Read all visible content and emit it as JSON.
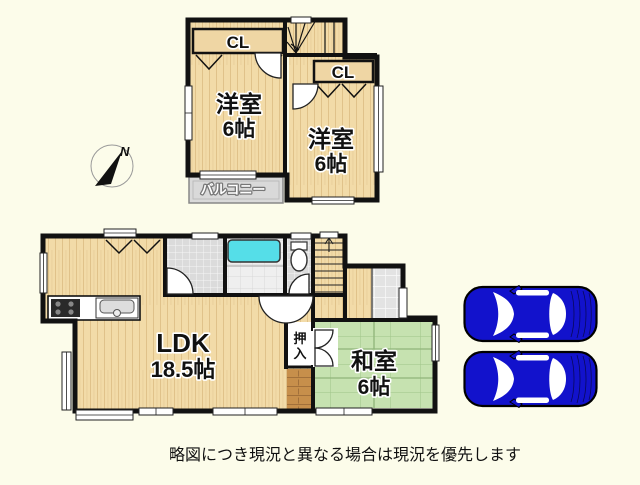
{
  "disclaimer": "略図につき現況と異なる場合は現況を優先します",
  "compass": {
    "label": "N"
  },
  "floor2": {
    "room_left": {
      "name": "洋室",
      "size": "6帖"
    },
    "room_right": {
      "name": "洋室",
      "size": "6帖"
    },
    "closet_left_label": "CL",
    "closet_right_label": "CL",
    "balcony_label": "バルコニー"
  },
  "floor1": {
    "ldk": {
      "name": "LDK",
      "size": "18.5帖"
    },
    "washitsu": {
      "name": "和室",
      "size": "6帖"
    },
    "oshiire": {
      "line1": "押",
      "line2": "入"
    }
  },
  "parking": {
    "car_count": 2
  },
  "colors": {
    "background": "#FCFCEA",
    "wall": "#111111",
    "wood_floor": "#F2DBA8",
    "tatami": "#C6E2B0",
    "bathtub": "#55DEE8",
    "balcony": "#D9D9D9",
    "dark_wood": "#C78F4B",
    "tile": "#DBDBDB",
    "car_body": "#1212CC"
  }
}
